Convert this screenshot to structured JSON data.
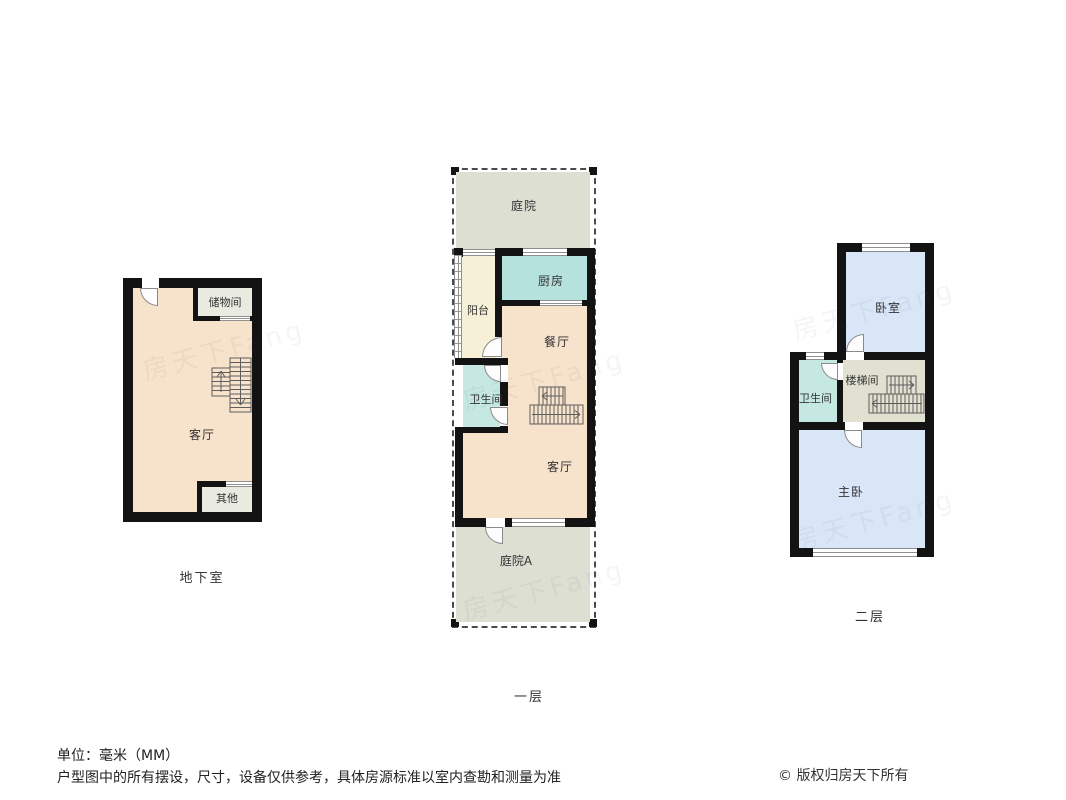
{
  "watermark": "房天下Fang",
  "plans": {
    "basement": {
      "floor_label": "地下室",
      "rooms": {
        "storage": "储物间",
        "living": "客厅",
        "other": "其他"
      }
    },
    "floor1": {
      "floor_label": "一层",
      "rooms": {
        "courtyard": "庭院",
        "balcony": "阳台",
        "kitchen": "厨房",
        "dining": "餐厅",
        "bathroom": "卫生间",
        "living": "客厅",
        "courtyard_a": "庭院A"
      }
    },
    "floor2": {
      "floor_label": "二层",
      "rooms": {
        "bedroom": "卧室",
        "bathroom": "卫生间",
        "stairwell": "楼梯间",
        "master_bedroom": "主卧"
      }
    }
  },
  "footer": {
    "unit": "单位：毫米（MM）",
    "disclaimer": "户型图中的所有摆设，尺寸，设备仅供参考，具体房源标准以室内查勘和测量为准",
    "copyright": "© 版权归房天下所有"
  },
  "colors": {
    "wall": "#131313",
    "room_warm": "#f7e2cb",
    "kitchen_teal": "#b6e2dd",
    "bath_teal": "#c5e8e3",
    "room_blue": "#d8e6f8",
    "balcony_cream": "#f6f1d6",
    "courtyard_green": "#dcdfd2",
    "stairwell_gray": "#e1e1d2",
    "utility_gray": "#e9ebe1"
  }
}
